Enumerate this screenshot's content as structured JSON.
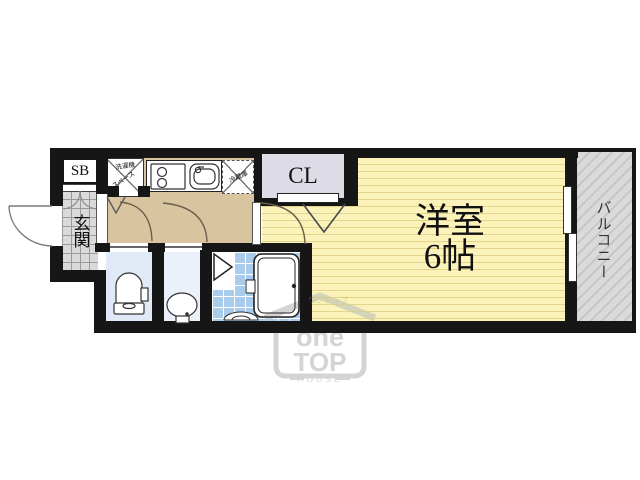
{
  "floorplan": {
    "entrance": {
      "shoebox_label": "SB",
      "genkan_label": "玄関"
    },
    "utility": {
      "washer_label_line1": "洗濯機",
      "washer_label_line2": "スペース",
      "fridge_label": "冷蔵庫"
    },
    "closet_label": "CL",
    "main_room": {
      "name": "洋室",
      "size": "6帖"
    },
    "balcony_label": "バルコニー",
    "colors": {
      "wall": "#161616",
      "hallway_floor": "#d8c5a0",
      "room_floor": "#fcf3ba",
      "room_stripe": "#e3d48e",
      "genkan_tile": "#dadada",
      "closet_fill": "#dcdbe6",
      "toilet_room": "#dfeaf6",
      "washroom": "#eaf1fa",
      "bath_tile": "#a9cbec",
      "balcony": "#d7d7d7"
    }
  },
  "watermark": {
    "brand_line1": "one",
    "brand_line2": "TOP",
    "brand_line3": "HOUSE",
    "faint_text": "ワントップ"
  }
}
